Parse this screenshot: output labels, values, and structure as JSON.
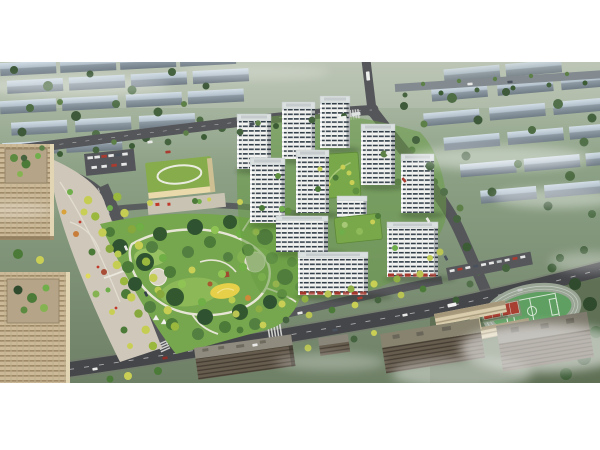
{
  "scene": {
    "alt": "Aerial architectural rendering of a residential development: white high-rise apartment towers around green courtyards, a large central park with winding paths and a yellow playground, a kindergarten with a green roof, beige office towers and a plaza on the left, a school with running track and red basketball courts at lower right, tree-lined boulevards, and misty rows of housing blocks in the background."
  },
  "palette": {
    "bg_top": "#b7c1b0",
    "bg_bottom": "#6e8066",
    "road_asphalt": "#55565a",
    "road_dark": "#45464a",
    "park_base": "#76a64d",
    "mist": "#ffffff",
    "awning": "#a5362b",
    "playground": "#e6cf49",
    "sports_field": "#5f9f62",
    "sports_court": "#a83f33",
    "plaza": "#cfc8ba",
    "kindergarten_roof": "#86ac4b",
    "roof_garden": "#79a84a",
    "tower_facade": "#f4f5f3",
    "tower_window": "#33404a",
    "tower_roof": "#dbe0e0",
    "office_wall": "#cbb998",
    "background_slab": "#b3c1cc",
    "ground_green": "#7e9077",
    "tree_dark": "#2f4a2c",
    "tree_mid": "#4c7a38",
    "tree_bright": "#6fae4a",
    "tree_yellow": "#c9cf55",
    "margin": "#ffffff"
  }
}
